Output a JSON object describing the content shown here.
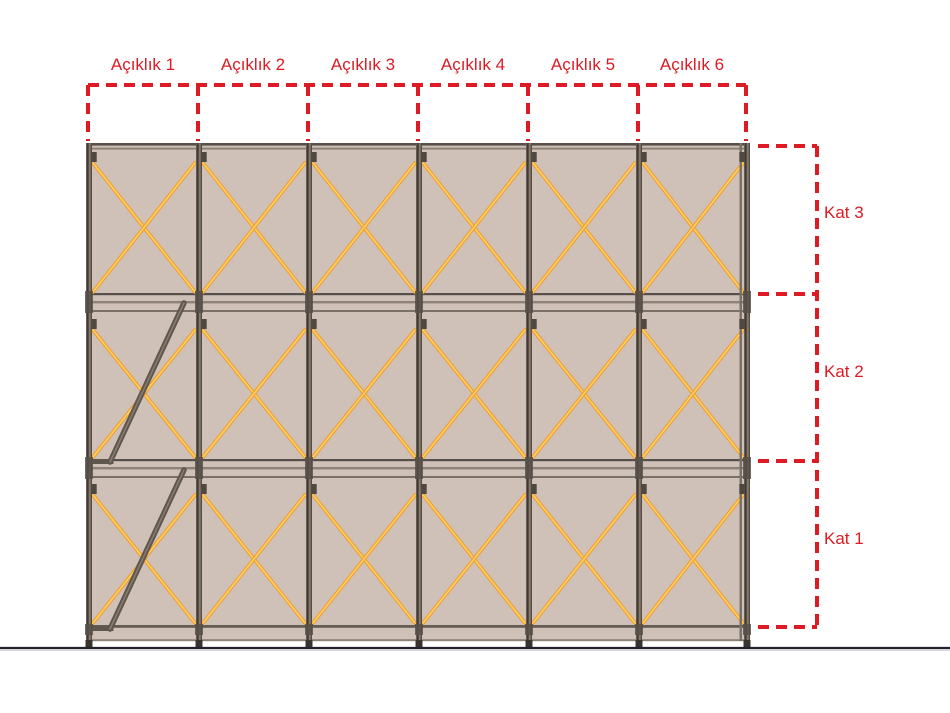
{
  "top_dimension": {
    "bays": [
      {
        "label": "Açıklık 1"
      },
      {
        "label": "Açıklık 2"
      },
      {
        "label": "Açıklık 3"
      },
      {
        "label": "Açıklık 4"
      },
      {
        "label": "Açıklık 5"
      },
      {
        "label": "Açıklık 6"
      }
    ]
  },
  "right_dimension": {
    "floors": [
      {
        "label": "Kat 3"
      },
      {
        "label": "Kat 2"
      },
      {
        "label": "Kat 1"
      }
    ]
  },
  "structure": {
    "bay_count": 6,
    "floor_count": 3,
    "bracing": "x-brace-every-bay-every-floor",
    "stairs": {
      "located_in_bay": "Açıklık 1",
      "floors_with_stair": [
        "Kat 2",
        "Kat 1"
      ]
    }
  },
  "colors": {
    "dimension_red": "#dc1b24",
    "panel": "#cfc0b8",
    "post_dark": "#39342f",
    "post_light": "#93826f",
    "brace": "#ef9f33",
    "brace_highlight": "#ffd264",
    "rail_dark": "#57504a",
    "rail_mid": "#7a7066",
    "rail_light": "#8e8277",
    "stair": "#5f574e",
    "stair_highlight": "#8a7c6f",
    "ground": "#23232e",
    "background": "#ffffff"
  }
}
